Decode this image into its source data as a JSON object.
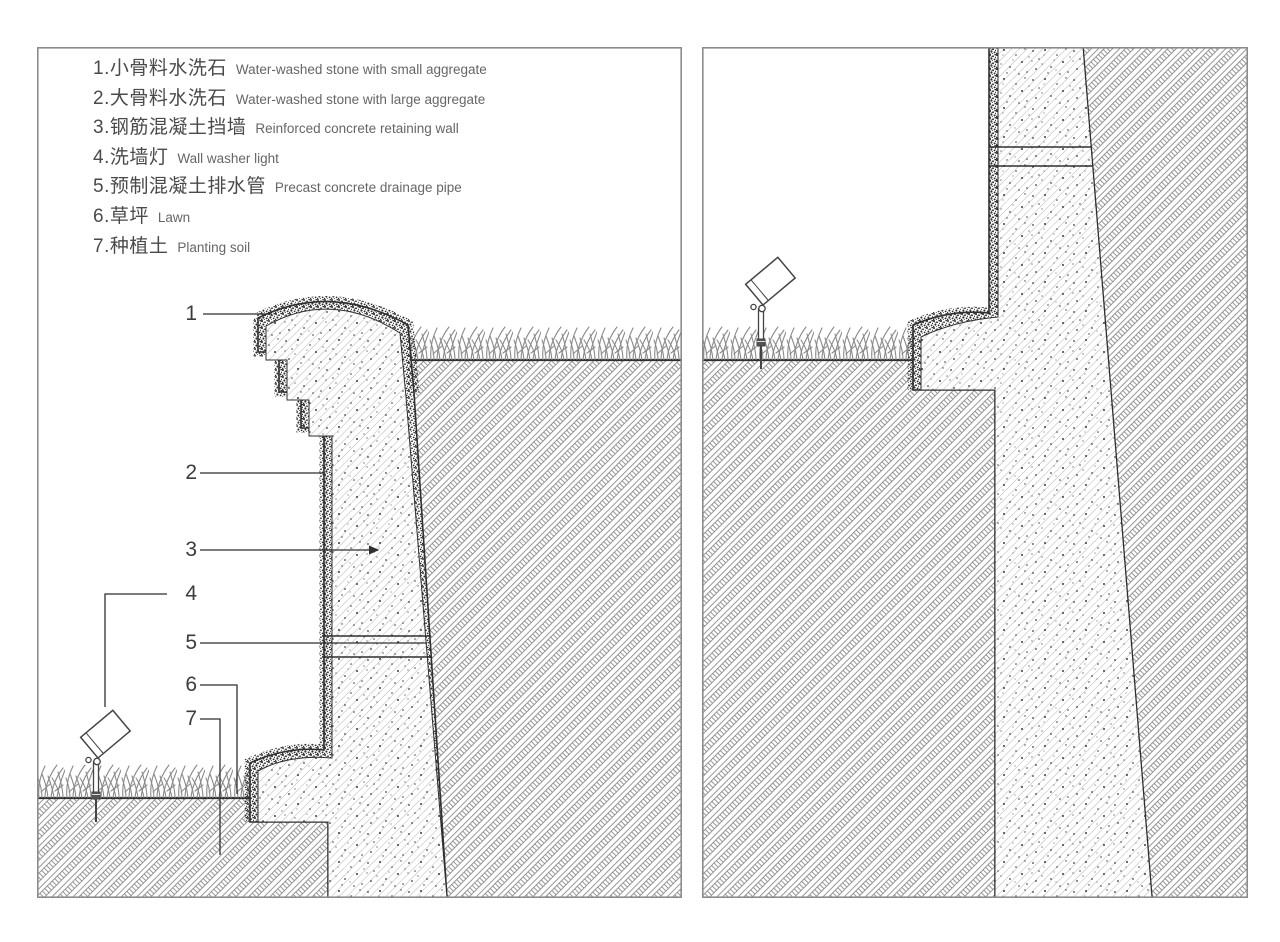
{
  "legend": {
    "items": [
      {
        "no": "1.",
        "zh": "小骨料水洗石",
        "en": "Water-washed stone with small aggregate"
      },
      {
        "no": "2.",
        "zh": "大骨料水洗石",
        "en": "Water-washed stone with large aggregate"
      },
      {
        "no": "3.",
        "zh": "钢筋混凝土挡墙",
        "en": "Reinforced concrete retaining wall"
      },
      {
        "no": "4.",
        "zh": "洗墙灯",
        "en": "Wall washer light"
      },
      {
        "no": "5.",
        "zh": "预制混凝土排水管",
        "en": "Precast concrete drainage pipe"
      },
      {
        "no": "6.",
        "zh": "草坪",
        "en": "Lawn"
      },
      {
        "no": "7.",
        "zh": "种植土",
        "en": "Planting soil"
      }
    ]
  },
  "callouts": {
    "labels": [
      "1",
      "2",
      "3",
      "4",
      "5",
      "6",
      "7"
    ]
  },
  "colors": {
    "line": "#2f2f2f",
    "panel_border": "#8c8c8c",
    "concrete_hatch": "#9c9c9c",
    "soil_hatch": "#7d7d7d",
    "stipple": "#2e2e2e",
    "grass": "#8a8a8a",
    "zh_text": "#4a4a4a",
    "en_text": "#666666",
    "background": "#ffffff"
  }
}
